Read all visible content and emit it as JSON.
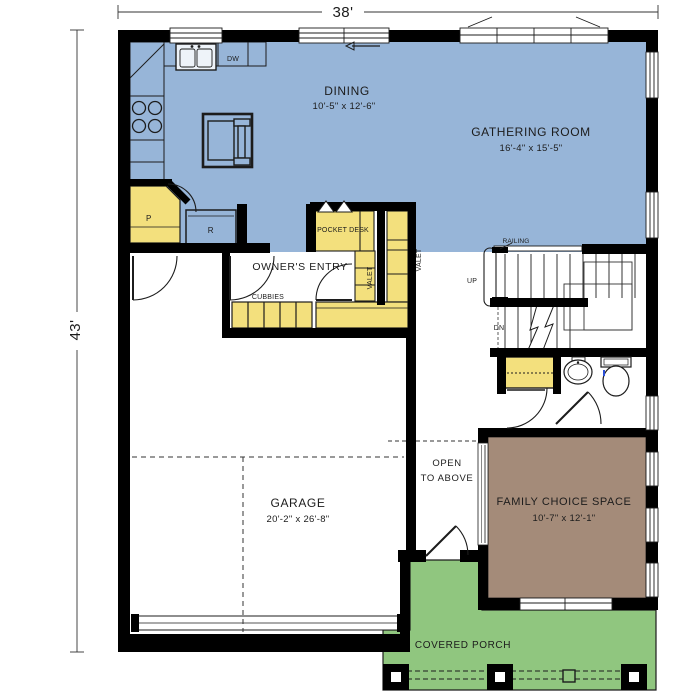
{
  "plan": {
    "dimensions": {
      "width": "38'",
      "height": "43'"
    },
    "rooms": {
      "dining": {
        "name": "DINING",
        "size": "10'-5\" x 12'-6\""
      },
      "gathering_room": {
        "name": "GATHERING ROOM",
        "size": "16'-4\" x 15'-5\""
      },
      "owners_entry": {
        "name": "OWNER'S ENTRY"
      },
      "garage": {
        "name": "GARAGE",
        "size": "20'-2\" x 26'-8\""
      },
      "family_choice_space": {
        "name": "FAMILY CHOICE SPACE",
        "size": "10'-7\" x 12'-1\""
      },
      "covered_porch": {
        "name": "COVERED PORCH"
      },
      "open_to_above": {
        "line1": "OPEN",
        "line2": "TO ABOVE"
      }
    },
    "features": {
      "pocket_desk": "POCKET DESK",
      "valet": "VALET",
      "cubbies": "CUBBIES",
      "railing": "RAILING",
      "up": "UP",
      "down": "DN",
      "dishwasher": "DW",
      "pantry": "P",
      "refrigerator": "R"
    },
    "colors": {
      "living_area": "#97b5d8",
      "cabinetry": "#f3e07d",
      "porch": "#90c67f",
      "family_space": "#a48b79",
      "walls": "#000000"
    }
  }
}
